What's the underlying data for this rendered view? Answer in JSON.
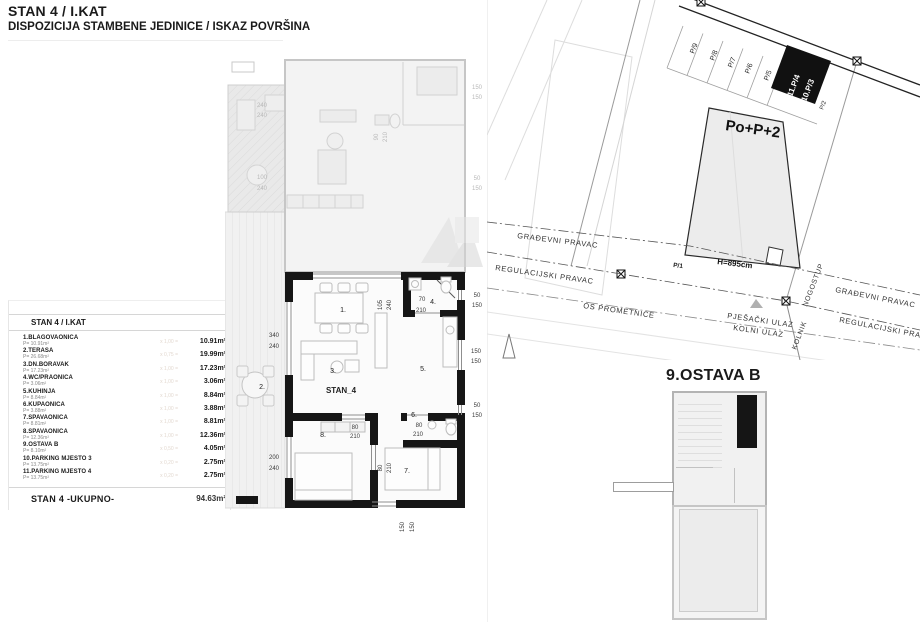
{
  "header": {
    "title": "STAN 4 / I.KAT",
    "subtitle": "DISPOZICIJA STAMBENE JEDINICE / ISKAZ POVRŠINA"
  },
  "area_table": {
    "header": "STAN 4 / I.KAT",
    "rows": [
      {
        "name": "1.BLAGOVAONICA",
        "sub": "P= 10.91m²",
        "factor": "x 1,00 =",
        "value": "10.91m²"
      },
      {
        "name": "2.TERASA",
        "sub": "P= 26.68m²",
        "factor": "x 0,75 =",
        "value": "19.99m²"
      },
      {
        "name": "3.DN.BORAVAK",
        "sub": "P= 17.23m²",
        "factor": "x 1,00 =",
        "value": "17.23m²"
      },
      {
        "name": "4.WC/PRAONICA",
        "sub": "P= 3.06m²",
        "factor": "x 1,00 =",
        "value": "3.06m²"
      },
      {
        "name": "5.KUHINJA",
        "sub": "P= 8.84m²",
        "factor": "x 1,00 =",
        "value": "8.84m²"
      },
      {
        "name": "6.KUPAONICA",
        "sub": "P= 3.88m²",
        "factor": "x 1,00 =",
        "value": "3.88m²"
      },
      {
        "name": "7.SPAVAONICA",
        "sub": "P= 8.81m²",
        "factor": "x 1,00 =",
        "value": "8.81m²"
      },
      {
        "name": "8.SPAVAONICA",
        "sub": "P= 12.36m²",
        "factor": "x 1,00 =",
        "value": "12.36m²"
      },
      {
        "name": "9.OSTAVA B",
        "sub": "P= 8.10m²",
        "factor": "x 0,50 =",
        "value": "4.05m²"
      },
      {
        "name": "10.PARKING MJESTO 3",
        "sub": "P= 13.75m²",
        "factor": "x 0,20 =",
        "value": "2.75m²"
      },
      {
        "name": "11.PARKING MJESTO 4",
        "sub": "P= 13.75m²",
        "factor": "x 0,20 =",
        "value": "2.75m²"
      }
    ],
    "total_label": "STAN 4 -UKUPNO-",
    "total_value": "94.63m²"
  },
  "floor_plan": {
    "unit_label": "STAN_4",
    "rooms": {
      "r1": "1.",
      "r2": "2.",
      "r3": "3.",
      "r4": "4.",
      "r5": "5.",
      "r6": "6.",
      "r7": "7.",
      "r8": "8."
    },
    "dims": {
      "u240a": "240",
      "u240b": "240",
      "u100": "100",
      "u240c": "240",
      "u90": "90",
      "u210": "210",
      "rf150a": "150",
      "rf150b": "150",
      "rf50": "50",
      "rf150c": "150",
      "w105": "105",
      "w240": "240",
      "wc70": "70",
      "wc210": "210",
      "t340": "340",
      "t240a": "240",
      "t200": "200",
      "t240b": "240",
      "d8a": "80",
      "d8b": "210",
      "d6a": "80",
      "d6b": "210",
      "d7a": "80",
      "d7b": "210",
      "b150a": "150",
      "b150b": "150",
      "r50a": "50",
      "r150a": "150",
      "r150b": "150",
      "r150c": "150",
      "r50b": "50",
      "r150d": "150"
    }
  },
  "site_plan": {
    "building_label": "Po+P+2",
    "height_label": "H=895cm",
    "parcel_label": "P/1",
    "parking": [
      "P/9",
      "P/8",
      "P/7",
      "P/6",
      "P/5"
    ],
    "parking_highlight_1": "11.P/4",
    "parking_highlight_2": "10.P/3",
    "parking_small": "P/2",
    "gradevni_pravac": "GRAĐEVNI PRAVAC",
    "regulacijski_pravac": "REGULACIJSKI PRAVAC",
    "os_prometnice": "OS PROMETNICE",
    "pjesacki_ulaz": "PJEŠAČKI ULAZ",
    "kolni_ulaz": "KOLNI ULAZ",
    "kolnik": "KOLNIK",
    "nogostup": "NOGOSTUP"
  },
  "storage_plan": {
    "title": "9.OSTAVA B"
  }
}
